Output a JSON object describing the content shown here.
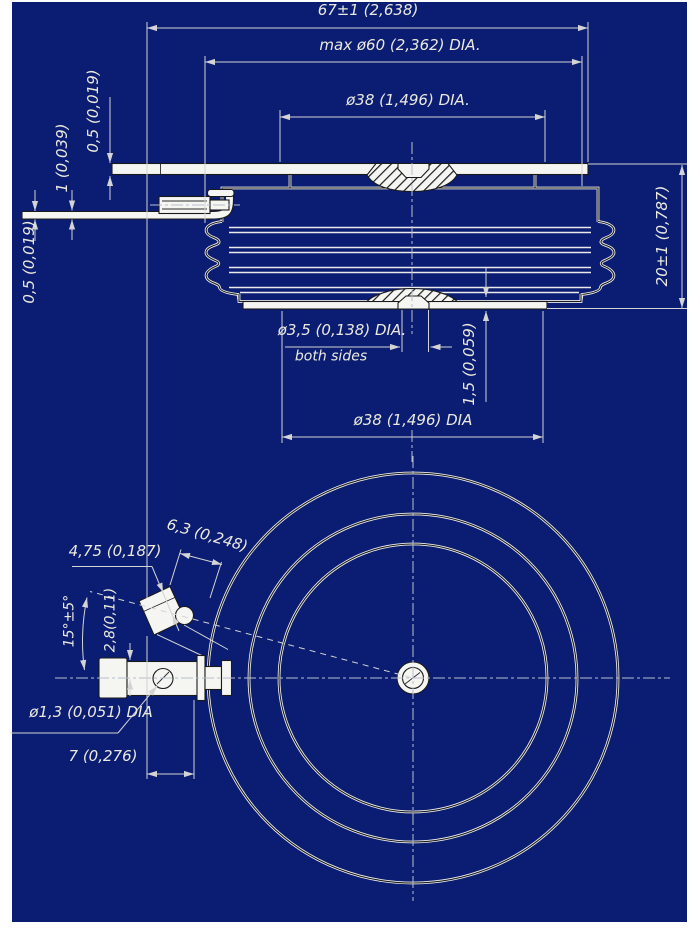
{
  "colors": {
    "page": "#ffffff",
    "canvas": "#0a1d72",
    "shape_fill": "#f5f5f1",
    "outline": "#1a1a1c",
    "halo": "#f0f0ec",
    "fin": "#ececec",
    "dim": "#d4d4d4",
    "centerline": "#b9bdcf",
    "text": "#eceade"
  },
  "drawing": {
    "type": "mechanical outline drawing, disc (capsule) semiconductor device",
    "views": [
      "side cross-section",
      "bottom circular view"
    ],
    "units_note": "millimetres (inches)"
  },
  "labels": {
    "overall_width": {
      "text": "67±1 (2,638)"
    },
    "max_body_dia": {
      "text": "max ø60 (2,362) DIA."
    },
    "pole_dia_top": {
      "text": "ø38 (1,496) DIA."
    },
    "plate_thickness": {
      "text": "0,5 (0,019)"
    },
    "lead_thickness": {
      "text": "1 (0,039)"
    },
    "strip_thickness": {
      "text": "0,5 (0,019)"
    },
    "height": {
      "text": "20±1 (0,787)"
    },
    "gate_hole_dia": {
      "text": "ø3,5 (0,138) DIA."
    },
    "gate_hole_note": {
      "text": "both  sides"
    },
    "recess_depth": {
      "text": "1,5 (0,059)"
    },
    "pole_dia_bottom": {
      "text": "ø38 (1,496) DIA"
    },
    "terminal_width": {
      "text": "4,75 (0,187)"
    },
    "terminal_length": {
      "text": "6,3 (0,248)"
    },
    "terminal_angle": {
      "text": "15°±5°"
    },
    "terminal_offset": {
      "text": "2,8(0,11)"
    },
    "wire_dia": {
      "text": "ø1,3 (0,051) DIA"
    },
    "terminal_projection": {
      "text": "7 (0,276)"
    }
  }
}
